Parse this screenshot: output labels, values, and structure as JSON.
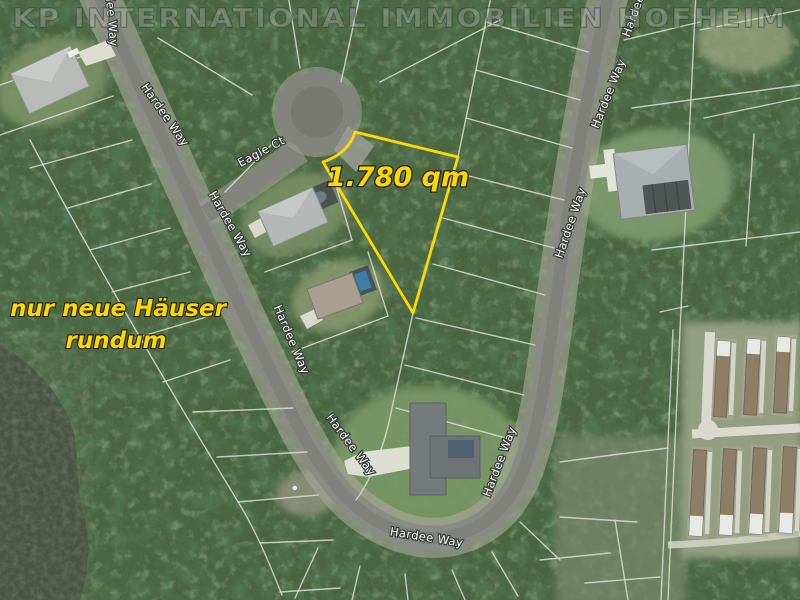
{
  "watermark": {
    "text": "KP INTERNATIONAL IMMOBILIEN HOFHEIM"
  },
  "annotations": {
    "area": {
      "text": "1.780 qm"
    },
    "note": {
      "lines": [
        "nur neue Häuser",
        "rundum"
      ]
    }
  },
  "streets": {
    "main_road_name": "Hardee Way",
    "court_name": "Eagle Ct"
  },
  "street_labels": [
    {
      "text": "Hardee Way",
      "x": 107,
      "y": 10,
      "rot": 85
    },
    {
      "text": "Hardee Way",
      "x": 162,
      "y": 117,
      "rot": 55
    },
    {
      "text": "Eagle Ct",
      "x": 263,
      "y": 155,
      "rot": -28
    },
    {
      "text": "Hardee Way",
      "x": 227,
      "y": 226,
      "rot": 60
    },
    {
      "text": "Hardee Way",
      "x": 288,
      "y": 341,
      "rot": 67
    },
    {
      "text": "Hardee Way",
      "x": 348,
      "y": 447,
      "rot": 53
    },
    {
      "text": "Hardee Way",
      "x": 426,
      "y": 541,
      "rot": 9
    },
    {
      "text": "Hardee Way",
      "x": 503,
      "y": 463,
      "rot": -69
    },
    {
      "text": "Hardee Way",
      "x": 574,
      "y": 224,
      "rot": -71
    },
    {
      "text": "Hardee Way",
      "x": 612,
      "y": 95,
      "rot": -68
    },
    {
      "text": "Hardee Way",
      "x": 642,
      "y": 3,
      "rot": -70
    }
  ],
  "colors": {
    "annotation_yellow": "#ffd800",
    "parcel_outline": "#ffd800",
    "street_label_fill": "#ffffff"
  }
}
